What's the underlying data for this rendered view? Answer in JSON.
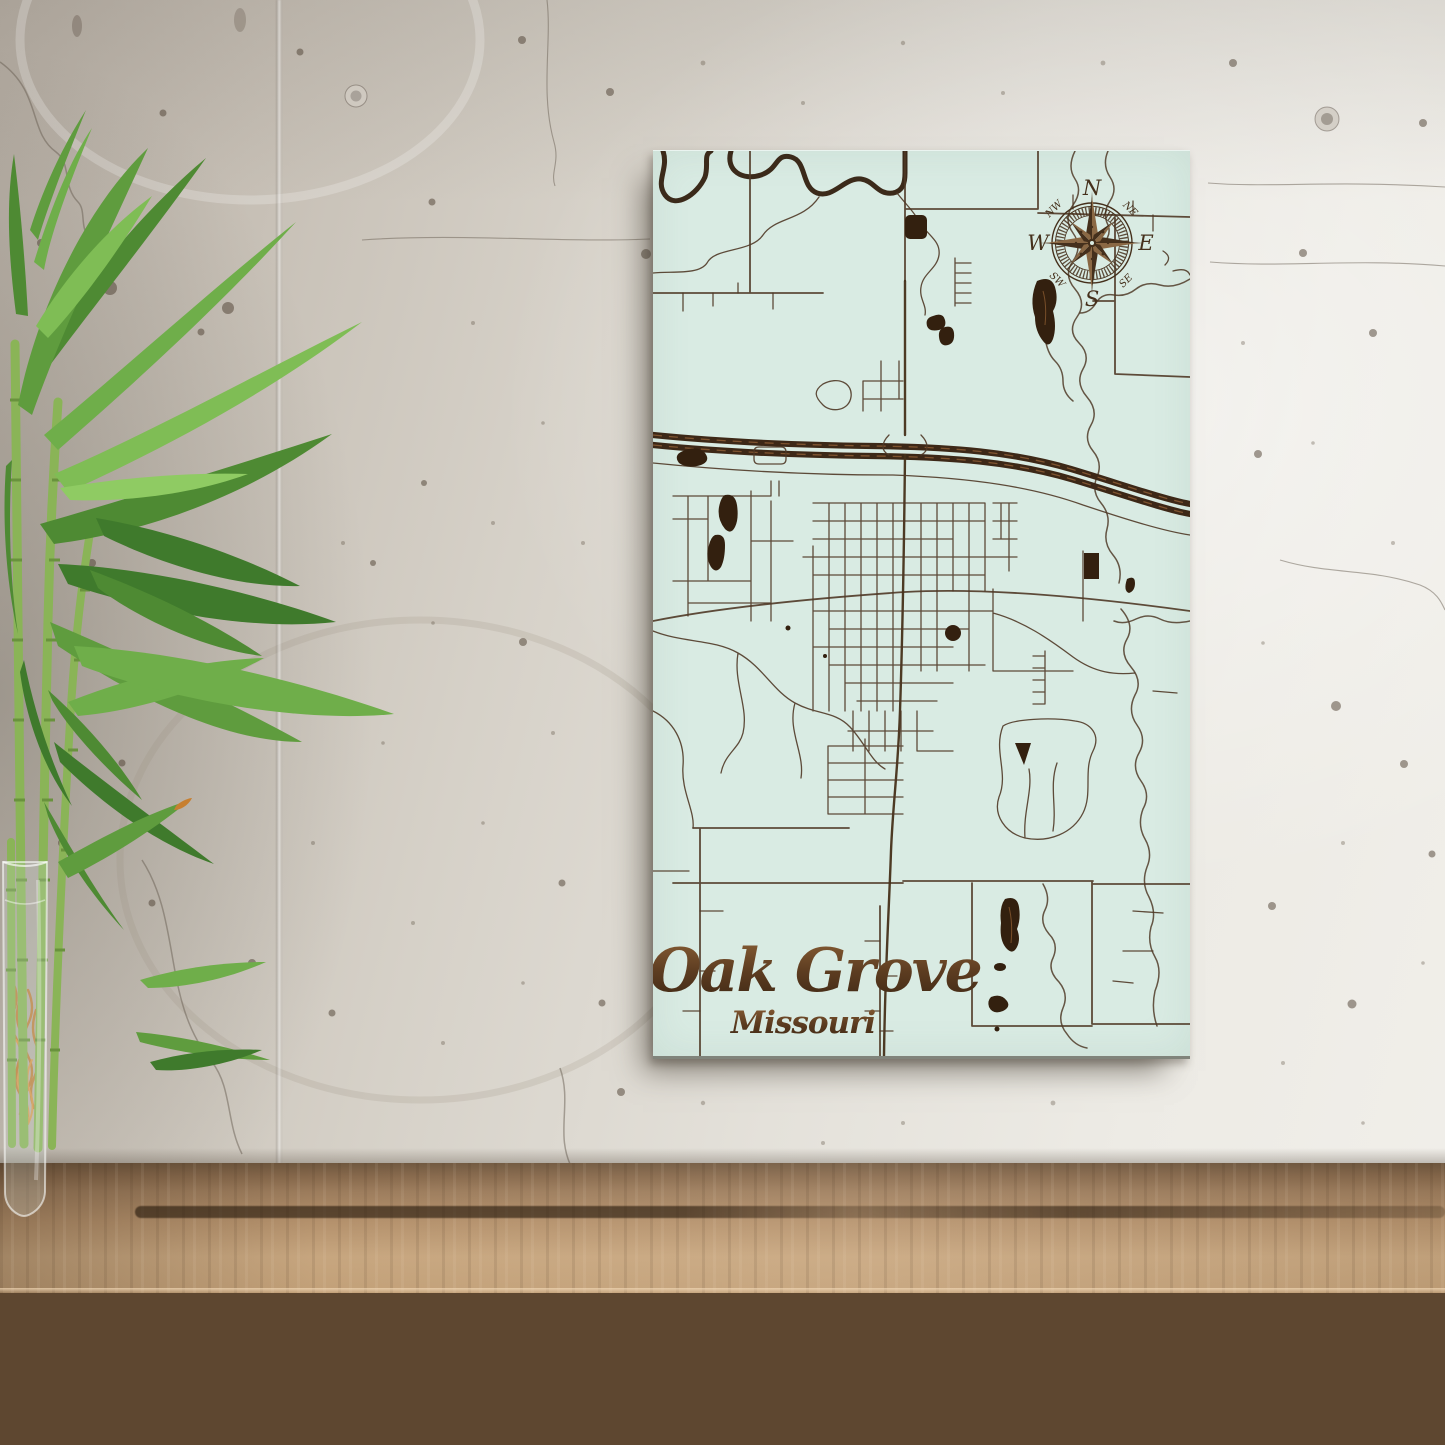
{
  "scene": {
    "type": "product-photo",
    "setting": "Engraved wood street map hanging on a speckled concrete wall above a rustic wooden table, with a lucky bamboo plant in a glass vase on the left"
  },
  "map_art": {
    "title": "Oak Grove",
    "subtitle": "Missouri",
    "background_color": "#d9ebe3",
    "road_color": "#4f3826",
    "dark_wood_color": "#33200f",
    "compass": {
      "north": "N",
      "east": "E",
      "south": "S",
      "west": "W",
      "northwest": "NW",
      "northeast": "NE",
      "southwest": "SW",
      "southeast": "SE"
    }
  },
  "wall": {
    "light_color": "#f1efea",
    "shadow_color": "#b4aca2"
  },
  "table": {
    "top_color": "#b4916c",
    "front_color": "#5e4730"
  },
  "plant": {
    "leaf_color": "#5f9c3e",
    "cane_color": "#8ab457",
    "root_color": "#c07a2e"
  }
}
